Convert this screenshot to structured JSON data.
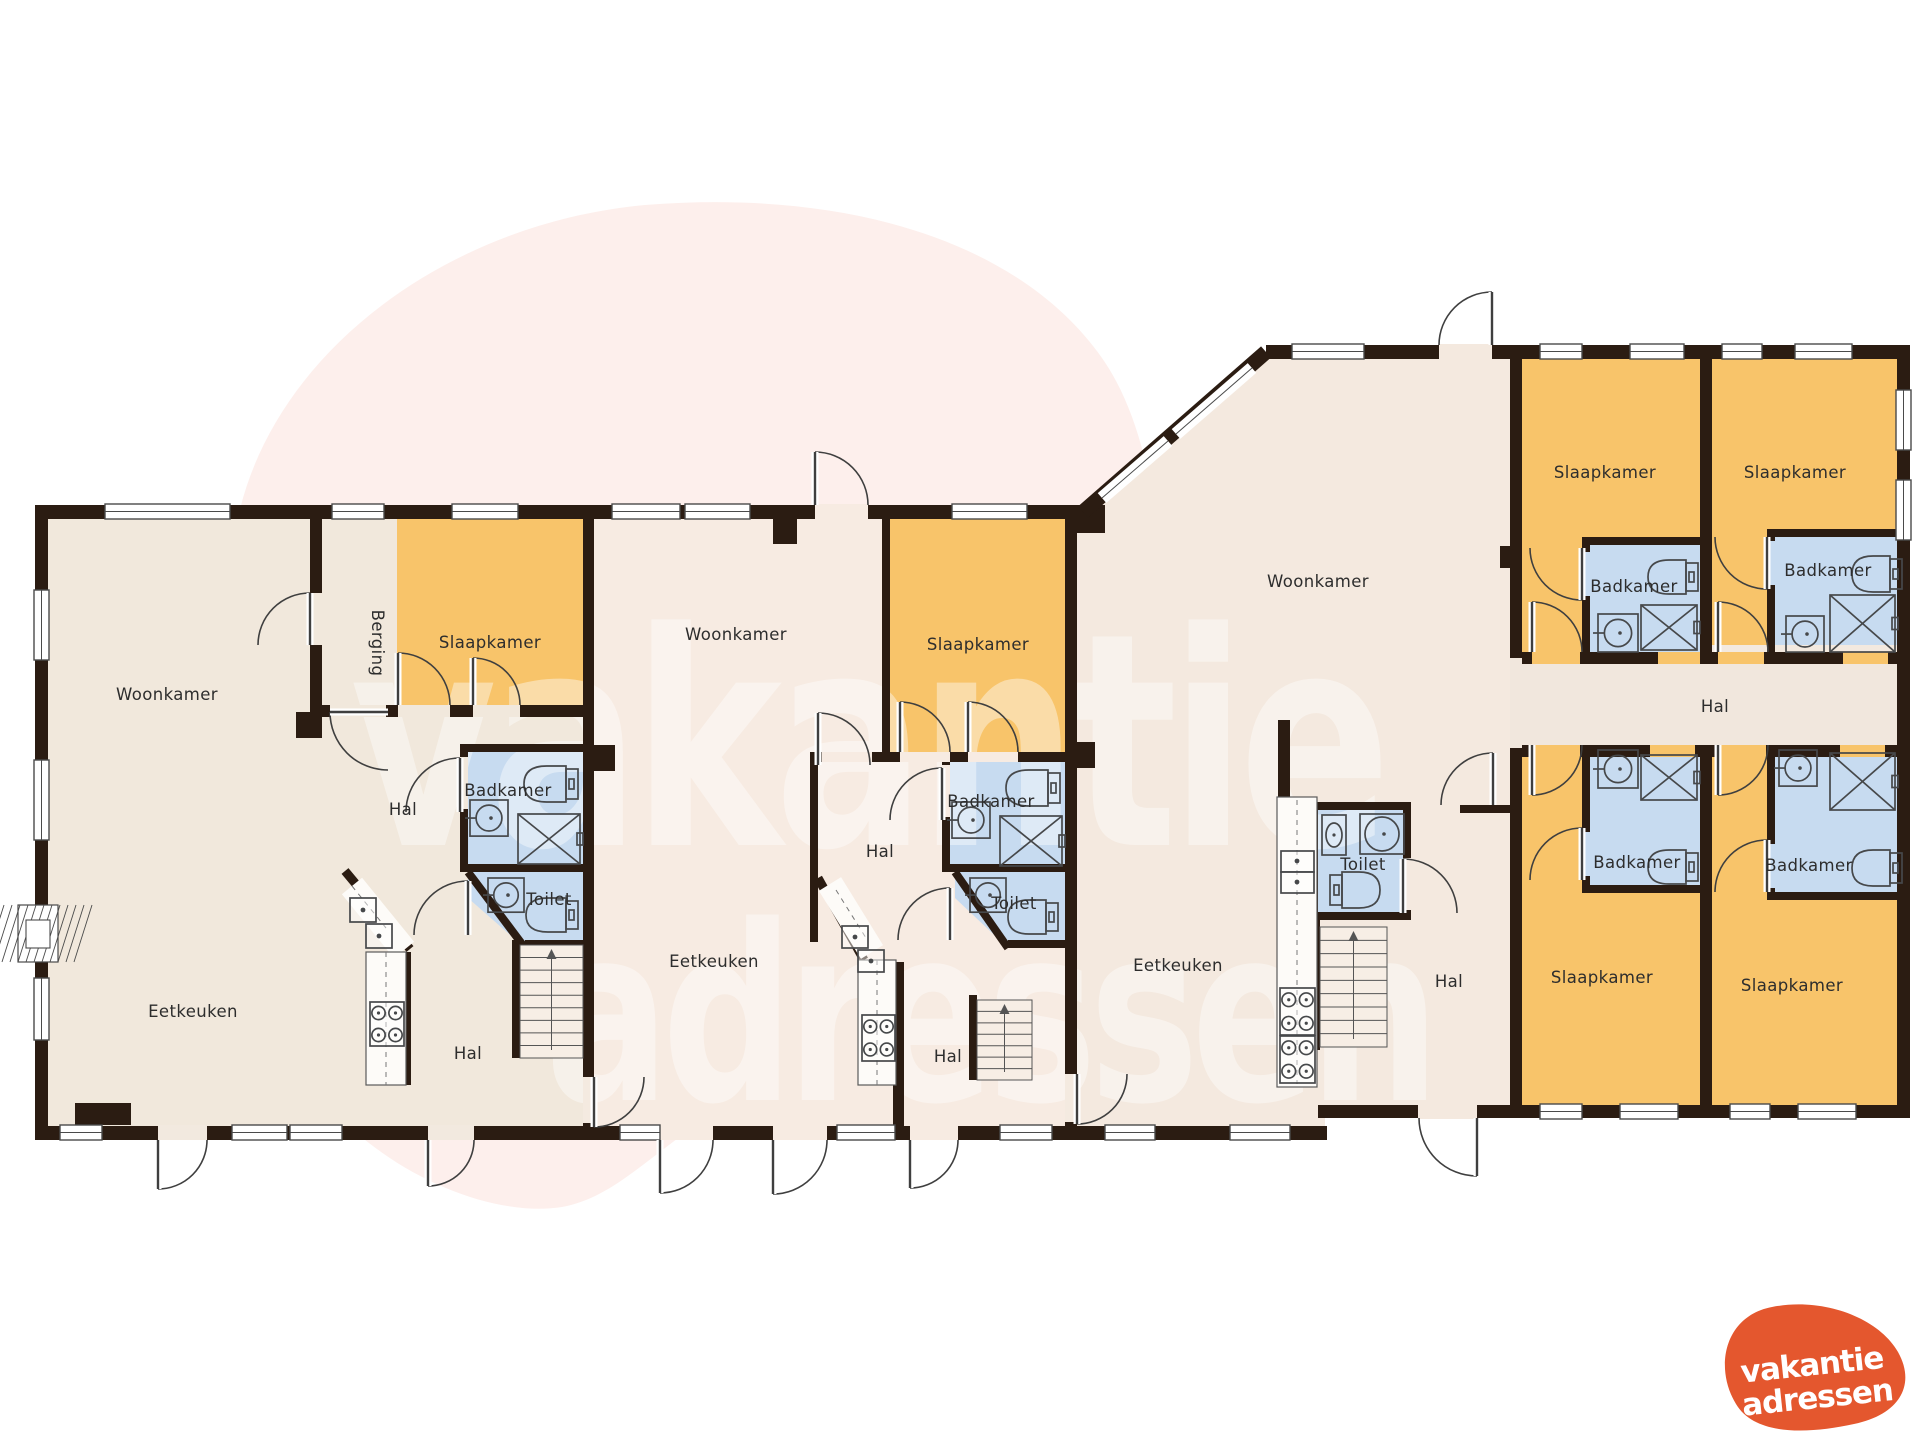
{
  "units": {
    "left": {
      "woonkamer": "Woonkamer",
      "berging": "Berging",
      "slaapkamer": "Slaapkamer",
      "hal_boven": "Hal",
      "badkamer": "Badkamer",
      "toilet": "Toilet",
      "eetkeuken": "Eetkeuken",
      "hal_onder": "Hal"
    },
    "middle": {
      "woonkamer": "Woonkamer",
      "slaapkamer": "Slaapkamer",
      "hal_boven": "Hal",
      "badkamer": "Badkamer",
      "toilet": "Toilet",
      "eetkeuken": "Eetkeuken",
      "hal_onder": "Hal"
    },
    "right": {
      "woonkamer": "Woonkamer",
      "toilet": "Toilet",
      "eetkeuken": "Eetkeuken",
      "hal": "Hal"
    },
    "wing": {
      "slaapkamer_1": "Slaapkamer",
      "slaapkamer_2": "Slaapkamer",
      "badkamer_1": "Badkamer",
      "badkamer_2": "Badkamer",
      "hal": "Hal",
      "badkamer_3": "Badkamer",
      "badkamer_4": "Badkamer",
      "slaapkamer_3": "Slaapkamer",
      "slaapkamer_4": "Slaapkamer"
    }
  },
  "watermark": {
    "line1": "vakantie",
    "line2": "adressen"
  },
  "logo": {
    "line1": "vakantie",
    "line2": "adressen"
  },
  "colors": {
    "wall": "#2b1c12",
    "bedroom": "#f8c46a",
    "bathroom": "#c7dbf0",
    "floor_left": "#f1e8dc",
    "floor_middle": "#f7ebe2",
    "floor_right": "#f4e9df",
    "floor_wing": "#f3e9df",
    "hal_wing": "#f1e7dd",
    "blob": "#fdefec",
    "watermark": "#ffffff",
    "logo_orange": "#e4572e",
    "label": "#2d2d2d"
  }
}
